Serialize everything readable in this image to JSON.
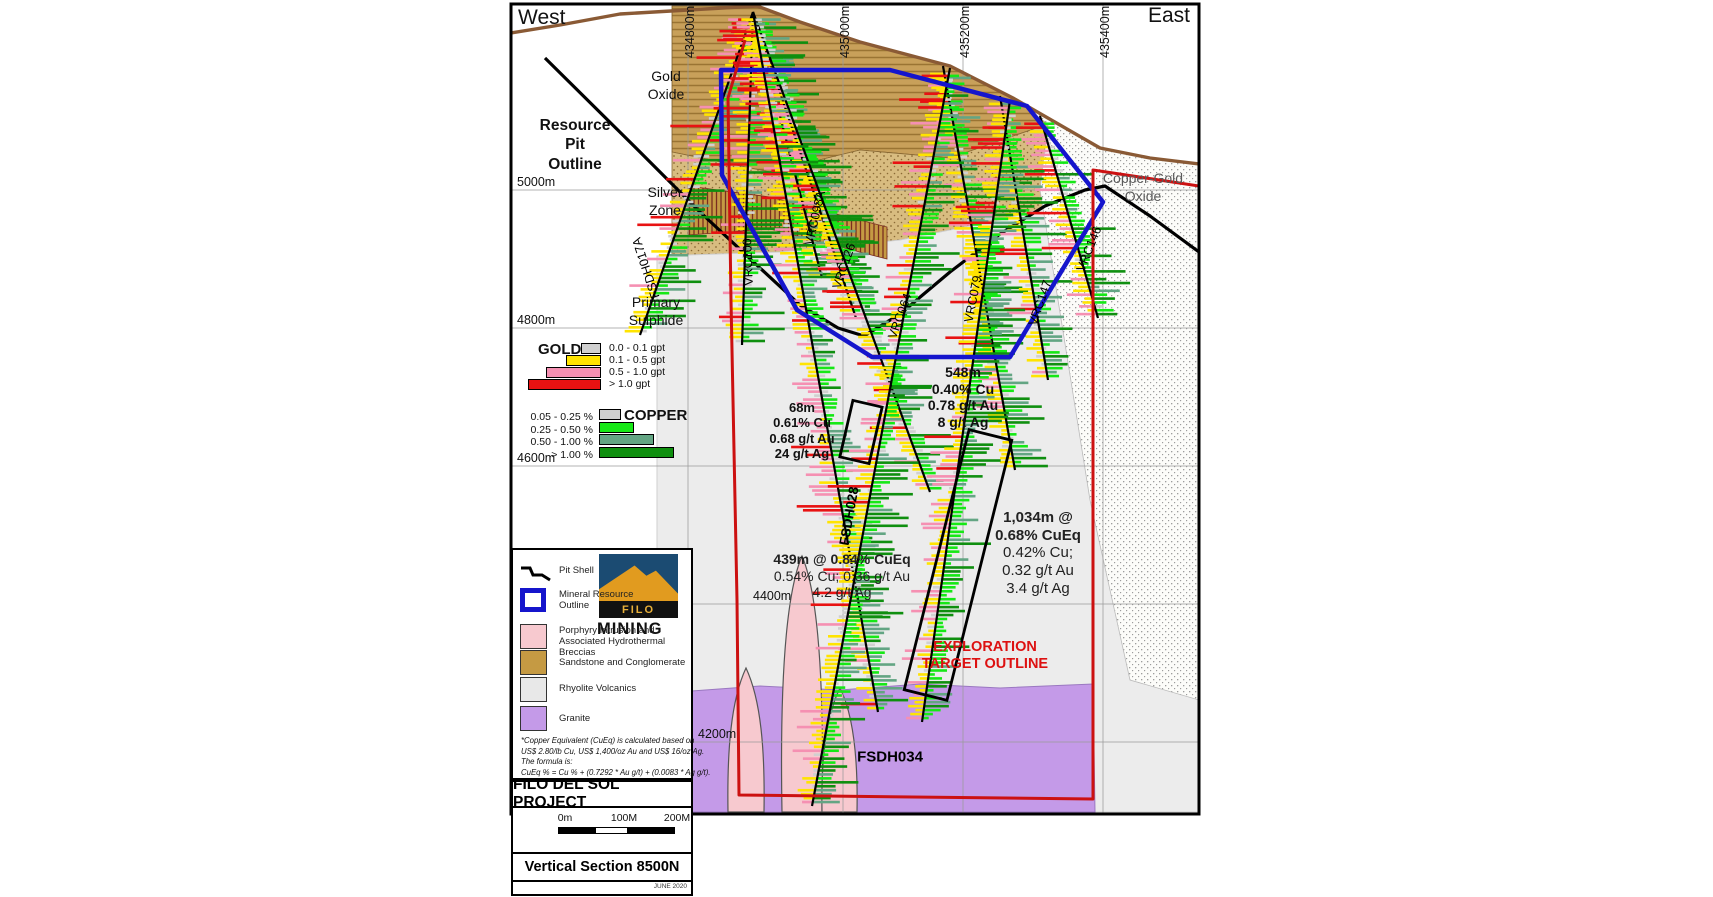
{
  "compass": {
    "west": "West",
    "east": "East"
  },
  "map": {
    "x": 511,
    "y": 4,
    "w": 688,
    "h": 810
  },
  "colors": {
    "au_classes": [
      "#d0d0d0",
      "#ffe400",
      "#f590b2",
      "#e81212"
    ],
    "cu_classes": [
      "#d0d0d0",
      "#16e816",
      "#63a583",
      "#0f8f0f"
    ],
    "resource_outline": "#1515cc",
    "exploration_outline": "#cc1111",
    "surface": "#8a5a35",
    "granite": "#c49ae8",
    "porphyry": "#f7c9cf",
    "rhyolite": "#ececec",
    "sand": "#c8a05a",
    "sand_line": "#9a7433",
    "sand_dot_bg": "#d8bc80",
    "sand_dot": "#8a6a35",
    "white_dot_bg": "#fcfcf9",
    "white_dot": "#909090",
    "hatch_bg": "#c59a43",
    "hatch_line": "#7a2d20",
    "grid": "#9a9a9a"
  },
  "grid": {
    "eastings": [
      {
        "label": "434800m",
        "x": 688
      },
      {
        "label": "435000m",
        "x": 843
      },
      {
        "label": "435200m",
        "x": 963
      },
      {
        "label": "435400m",
        "x": 1103
      }
    ],
    "elevations": [
      {
        "label": "5000m",
        "y": 190,
        "lx": 517
      },
      {
        "label": "4800m",
        "y": 328,
        "lx": 517
      },
      {
        "label": "4600m",
        "y": 466,
        "lx": 517
      },
      {
        "label": "4400m",
        "y": 604,
        "lx": 753
      },
      {
        "label": "4200m",
        "y": 742,
        "lx": 698
      }
    ]
  },
  "zone_labels": [
    {
      "text": "Gold\nOxide",
      "x": 666,
      "y": 68,
      "size": 14,
      "bold": false,
      "color": "#111"
    },
    {
      "text": "Resource\nPit\nOutline",
      "x": 575,
      "y": 116,
      "size": 15.5,
      "bold": true,
      "color": "#111"
    },
    {
      "text": "Silver\nZone",
      "x": 665,
      "y": 184,
      "size": 14,
      "bold": false,
      "color": "#111"
    },
    {
      "text": "Primary\nSulphide",
      "x": 656,
      "y": 294,
      "size": 14,
      "bold": false,
      "color": "#111"
    },
    {
      "text": "Copper-Gold\nOxide",
      "x": 1143,
      "y": 170,
      "size": 14,
      "bold": false,
      "color": "#5a5a5a"
    }
  ],
  "gold_legend": {
    "title": "GOLD",
    "bar_right": 601,
    "top": 343,
    "entries": [
      {
        "label": "0.0 - 0.1 gpt",
        "color": "#d0d0d0",
        "w": 20
      },
      {
        "label": "0.1 - 0.5 gpt",
        "color": "#ffe400",
        "w": 35
      },
      {
        "label": "0.5 - 1.0 gpt",
        "color": "#f590b2",
        "w": 55
      },
      {
        "label": "> 1.0 gpt",
        "color": "#e81212",
        "w": 73
      }
    ]
  },
  "copper_legend": {
    "title": "COPPER",
    "bar_left": 599,
    "top": 409,
    "entries": [
      {
        "label": "0.05 - 0.25 %",
        "color": "#d0d0d0",
        "w": 22
      },
      {
        "label": "0.25 - 0.50 %",
        "color": "#16e816",
        "w": 35
      },
      {
        "label": "0.50 - 1.00 %",
        "color": "#63a583",
        "w": 55
      },
      {
        "label": "> 1.00 %",
        "color": "#0f8f0f",
        "w": 75
      }
    ]
  },
  "map_legend": {
    "items": [
      {
        "type": "pitshell",
        "label": "Pit Shell",
        "sy": 12,
        "ly": 16
      },
      {
        "type": "resource",
        "label": "Mineral Resource\nOutline",
        "sy": 38,
        "ly": 40
      },
      {
        "type": "swatch",
        "color": "#f7c9cf",
        "label": "Porphyry Intrusion and\nAssociated Hydrothermal Breccias",
        "sy": 74,
        "ly": 76
      },
      {
        "type": "swatch",
        "color": "#c59a43",
        "label": "Sandstone and Conglomerate",
        "sy": 100,
        "ly": 108
      },
      {
        "type": "swatch",
        "color": "#e8e8e8",
        "label": "Rhyolite Volcanics",
        "sy": 127,
        "ly": 134
      },
      {
        "type": "swatch",
        "color": "#c49ae8",
        "label": "Granite",
        "sy": 156,
        "ly": 164
      }
    ],
    "footnote": [
      "*Copper Equivalent (CuEq) is calculated based on",
      "US$ 2.80/lb Cu, US$ 1,400/oz Au and US$ 16/oz Ag.",
      "The formula is:",
      "CuEq % = Cu % + (0.7292 * Au g/t) + (0.0083 * Ag g/t)."
    ]
  },
  "logo": {
    "name": "FILO",
    "sub": "MINING"
  },
  "title_block": {
    "project": "FILO DEL SOL PROJECT",
    "section": "Vertical Section 8500N",
    "date": "JUNE 2020",
    "scale_labels": [
      {
        "label": "0m",
        "x": 563
      },
      {
        "label": "100M",
        "x": 622
      },
      {
        "label": "200M",
        "x": 675
      }
    ]
  },
  "annotations": [
    {
      "lines": [
        "68m",
        "0.61% Cu",
        "0.68 g/t Au",
        "24 g/t Ag"
      ],
      "bold": 4,
      "x": 802,
      "y": 400,
      "size": 13,
      "color": "#111"
    },
    {
      "lines": [
        "548m",
        "0.40% Cu",
        "0.78 g/t Au",
        "8 g/t Ag"
      ],
      "bold": 4,
      "x": 963,
      "y": 364,
      "size": 14,
      "color": "#111"
    },
    {
      "lines": [
        "439m @ 0.84% CuEq",
        "0.54% Cu; 0.36 g/t Au",
        "4.2 g/t Ag"
      ],
      "bold": 1,
      "x": 842,
      "y": 551,
      "size": 14,
      "color": "#222"
    },
    {
      "lines": [
        "1,034m @",
        "0.68% CuEq",
        "0.42% Cu;",
        "0.32 g/t Au",
        "3.4 g/t Ag"
      ],
      "bold": 2,
      "x": 1038,
      "y": 509,
      "size": 15,
      "color": "#222"
    },
    {
      "lines": [
        "EXPLORATION",
        "TARGET OUTLINE"
      ],
      "bold": 2,
      "x": 985,
      "y": 639,
      "size": 14.5,
      "color": "#dd1111"
    }
  ],
  "geology": {
    "sand_lined": [
      [
        672,
        6
      ],
      [
        757,
        6
      ],
      [
        800,
        22
      ],
      [
        860,
        42
      ],
      [
        950,
        66
      ],
      [
        1013,
        98
      ],
      [
        1048,
        124
      ],
      [
        950,
        158
      ],
      [
        860,
        150
      ],
      [
        770,
        172
      ],
      [
        672,
        152
      ]
    ],
    "sand_dotted": [
      [
        672,
        152
      ],
      [
        770,
        172
      ],
      [
        860,
        150
      ],
      [
        950,
        158
      ],
      [
        1048,
        124
      ],
      [
        1090,
        150
      ],
      [
        1090,
        196
      ],
      [
        1000,
        220
      ],
      [
        900,
        240
      ],
      [
        780,
        252
      ],
      [
        672,
        256
      ]
    ],
    "rhyolite": [
      [
        657,
        256
      ],
      [
        780,
        252
      ],
      [
        900,
        240
      ],
      [
        1000,
        220
      ],
      [
        1090,
        196
      ],
      [
        1199,
        240
      ],
      [
        1199,
        812
      ],
      [
        657,
        812
      ]
    ],
    "white_dotted": [
      [
        1013,
        98
      ],
      [
        1060,
        125
      ],
      [
        1100,
        148
      ],
      [
        1150,
        158
      ],
      [
        1199,
        164
      ],
      [
        1199,
        700
      ],
      [
        1130,
        680
      ],
      [
        1090,
        500
      ],
      [
        1058,
        300
      ],
      [
        1040,
        190
      ],
      [
        1048,
        124
      ]
    ],
    "granite": [
      [
        678,
        692
      ],
      [
        760,
        686
      ],
      [
        840,
        690
      ],
      [
        920,
        684
      ],
      [
        1000,
        688
      ],
      [
        1093,
        684
      ],
      [
        1095,
        812
      ],
      [
        678,
        812
      ]
    ],
    "silver_hatch": [
      [
        688,
        186
      ],
      [
        770,
        197
      ],
      [
        887,
        227
      ],
      [
        887,
        259
      ],
      [
        770,
        229
      ],
      [
        688,
        235
      ]
    ],
    "porphyry_blobs": [
      "M 782,812 C 780,700 784,598 802,556 C 820,598 824,700 822,812 Z",
      "M 728,812 C 727,750 731,700 746,668 C 761,700 765,750 764,812 Z",
      "M 822,812 C 821,760 826,716 840,688 C 854,716 858,760 857,812 Z"
    ]
  },
  "outlines": {
    "surface": [
      [
        511,
        33
      ],
      [
        560,
        25
      ],
      [
        620,
        14
      ],
      [
        688,
        10
      ],
      [
        757,
        6
      ],
      [
        800,
        22
      ],
      [
        860,
        42
      ],
      [
        950,
        66
      ],
      [
        1013,
        98
      ],
      [
        1060,
        125
      ],
      [
        1100,
        148
      ],
      [
        1150,
        158
      ],
      [
        1199,
        164
      ]
    ],
    "pit_shell": [
      [
        545,
        58
      ],
      [
        640,
        152
      ],
      [
        700,
        212
      ],
      [
        760,
        268
      ],
      [
        800,
        305
      ],
      [
        838,
        328
      ],
      [
        864,
        336
      ],
      [
        900,
        314
      ],
      [
        950,
        272
      ],
      [
        1000,
        234
      ],
      [
        1045,
        206
      ],
      [
        1085,
        190
      ],
      [
        1105,
        186
      ],
      [
        1150,
        216
      ],
      [
        1199,
        252
      ]
    ],
    "resource": [
      [
        721,
        70
      ],
      [
        890,
        70
      ],
      [
        1027,
        106
      ],
      [
        1103,
        202
      ],
      [
        1010,
        357
      ],
      [
        872,
        357
      ],
      [
        797,
        310
      ],
      [
        722,
        175
      ]
    ],
    "exploration": [
      [
        745,
        40
      ],
      [
        728,
        98
      ],
      [
        731,
        300
      ],
      [
        737,
        600
      ],
      [
        739,
        795
      ],
      [
        1093,
        799
      ],
      [
        1093,
        170
      ],
      [
        1199,
        186
      ]
    ]
  },
  "drill_holes": [
    {
      "name": "FSDH017A",
      "collar": [
        753,
        12
      ],
      "end": [
        640,
        335
      ],
      "label": {
        "x": 646,
        "y": 268,
        "rot": -108,
        "bold": false,
        "size": 12.5
      },
      "profile": "oxide",
      "seed": 11
    },
    {
      "name": "VRC100",
      "collar": [
        753,
        12
      ],
      "end": [
        742,
        345
      ],
      "label": {
        "x": 748,
        "y": 262,
        "rot": -92,
        "bold": false,
        "size": 12.5
      },
      "profile": "oxide",
      "seed": 22
    },
    {
      "name": "VRC098A",
      "collar": [
        753,
        12
      ],
      "end": [
        822,
        278
      ],
      "label": {
        "x": 815,
        "y": 218,
        "rot": -77,
        "bold": false,
        "size": 12.5
      },
      "profile": "oxide",
      "seed": 33
    },
    {
      "name": "VRC126",
      "collar": [
        753,
        12
      ],
      "end": [
        856,
        318
      ],
      "label": {
        "x": 844,
        "y": 266,
        "rot": -71,
        "bold": false,
        "size": 12.5
      },
      "profile": "oxide",
      "seed": 44
    },
    {
      "name": "VRC064",
      "collar": [
        753,
        12
      ],
      "end": [
        930,
        492
      ],
      "label": {
        "x": 900,
        "y": 316,
        "rot": -70,
        "bold": false,
        "size": 12.5
      },
      "profile": "mid",
      "seed": 55
    },
    {
      "name": "FSDH028",
      "collar": [
        753,
        12
      ],
      "end": [
        878,
        712
      ],
      "label": {
        "x": 849,
        "y": 516,
        "rot": -80,
        "bold": true,
        "size": 13.5
      },
      "profile": "deepA",
      "seed": 66
    },
    {
      "name": "VRC079",
      "collar": [
        943,
        66
      ],
      "end": [
        1015,
        470
      ],
      "label": {
        "x": 973,
        "y": 299,
        "rot": -79,
        "bold": false,
        "size": 12.5
      },
      "profile": "mid",
      "seed": 77
    },
    {
      "name": "FSDH034",
      "collar": [
        950,
        68
      ],
      "end": [
        812,
        806
      ],
      "label": {
        "x": 890,
        "y": 757,
        "rot": 0,
        "bold": true,
        "size": 15
      },
      "profile": "deepB",
      "seed": 88
    },
    {
      "name": "VRC147",
      "collar": [
        1000,
        96
      ],
      "end": [
        1048,
        380
      ],
      "label": {
        "x": 1040,
        "y": 303,
        "rot": -71,
        "bold": false,
        "size": 12.5
      },
      "profile": "mid",
      "seed": 99
    },
    {
      "name": "VRC146",
      "collar": [
        1040,
        116
      ],
      "end": [
        1098,
        318
      ],
      "label": {
        "x": 1089,
        "y": 249,
        "rot": -68,
        "bold": false,
        "size": 12.5
      },
      "profile": "oxide",
      "seed": 111
    },
    {
      "name": "",
      "collar": [
        1010,
        100
      ],
      "end": [
        922,
        722
      ],
      "label": null,
      "profile": "deepB",
      "seed": 122
    }
  ],
  "profiles": {
    "oxide": [
      {
        "u": 0.3,
        "au": [
          1,
          5,
          3,
          3
        ],
        "cu": [
          4,
          3,
          1,
          0.5
        ]
      },
      {
        "u": 0.65,
        "au": [
          1,
          6,
          2,
          1
        ],
        "cu": [
          1.5,
          4,
          2,
          3
        ]
      },
      {
        "u": 1,
        "au": [
          2,
          5,
          1,
          0.4
        ],
        "cu": [
          1,
          3,
          2,
          4
        ]
      }
    ],
    "mid": [
      {
        "u": 0.22,
        "au": [
          1,
          4,
          3,
          2.5
        ],
        "cu": [
          3,
          3,
          1,
          0.5
        ]
      },
      {
        "u": 0.6,
        "au": [
          1,
          6,
          1.5,
          0.5
        ],
        "cu": [
          1,
          4,
          2,
          3
        ]
      },
      {
        "u": 1,
        "au": [
          2,
          5,
          1,
          0.3
        ],
        "cu": [
          1,
          4,
          2.5,
          2.5
        ]
      }
    ],
    "deepA": [
      {
        "u": 0.28,
        "au": [
          1,
          5,
          2,
          2
        ],
        "cu": [
          3,
          3,
          1,
          0.5
        ]
      },
      {
        "u": 0.52,
        "au": [
          1,
          5,
          2,
          0.7
        ],
        "cu": [
          1,
          4,
          2,
          2
        ]
      },
      {
        "u": 0.72,
        "au": [
          0.5,
          2.5,
          6,
          1
        ],
        "cu": [
          2,
          3,
          1.5,
          1
        ]
      },
      {
        "u": 1,
        "au": [
          1,
          5,
          2,
          0.4
        ],
        "cu": [
          1,
          4,
          2.5,
          2
        ]
      }
    ],
    "deepB": [
      {
        "u": 0.2,
        "au": [
          1,
          4,
          3,
          2
        ],
        "cu": [
          2,
          4,
          1.5,
          1
        ]
      },
      {
        "u": 0.55,
        "au": [
          1,
          6,
          2,
          0.6
        ],
        "cu": [
          0.8,
          5,
          2,
          2.5
        ]
      },
      {
        "u": 1,
        "au": [
          1.2,
          6,
          1.5,
          0.4
        ],
        "cu": [
          0.6,
          5,
          2,
          3
        ]
      }
    ]
  },
  "interval_boxes": [
    {
      "cx": 861,
      "cy": 432,
      "w": 30,
      "h": 58,
      "rot": 13
    },
    {
      "cx": 958,
      "cy": 565,
      "w": 44,
      "h": 268,
      "rot": 14
    }
  ]
}
